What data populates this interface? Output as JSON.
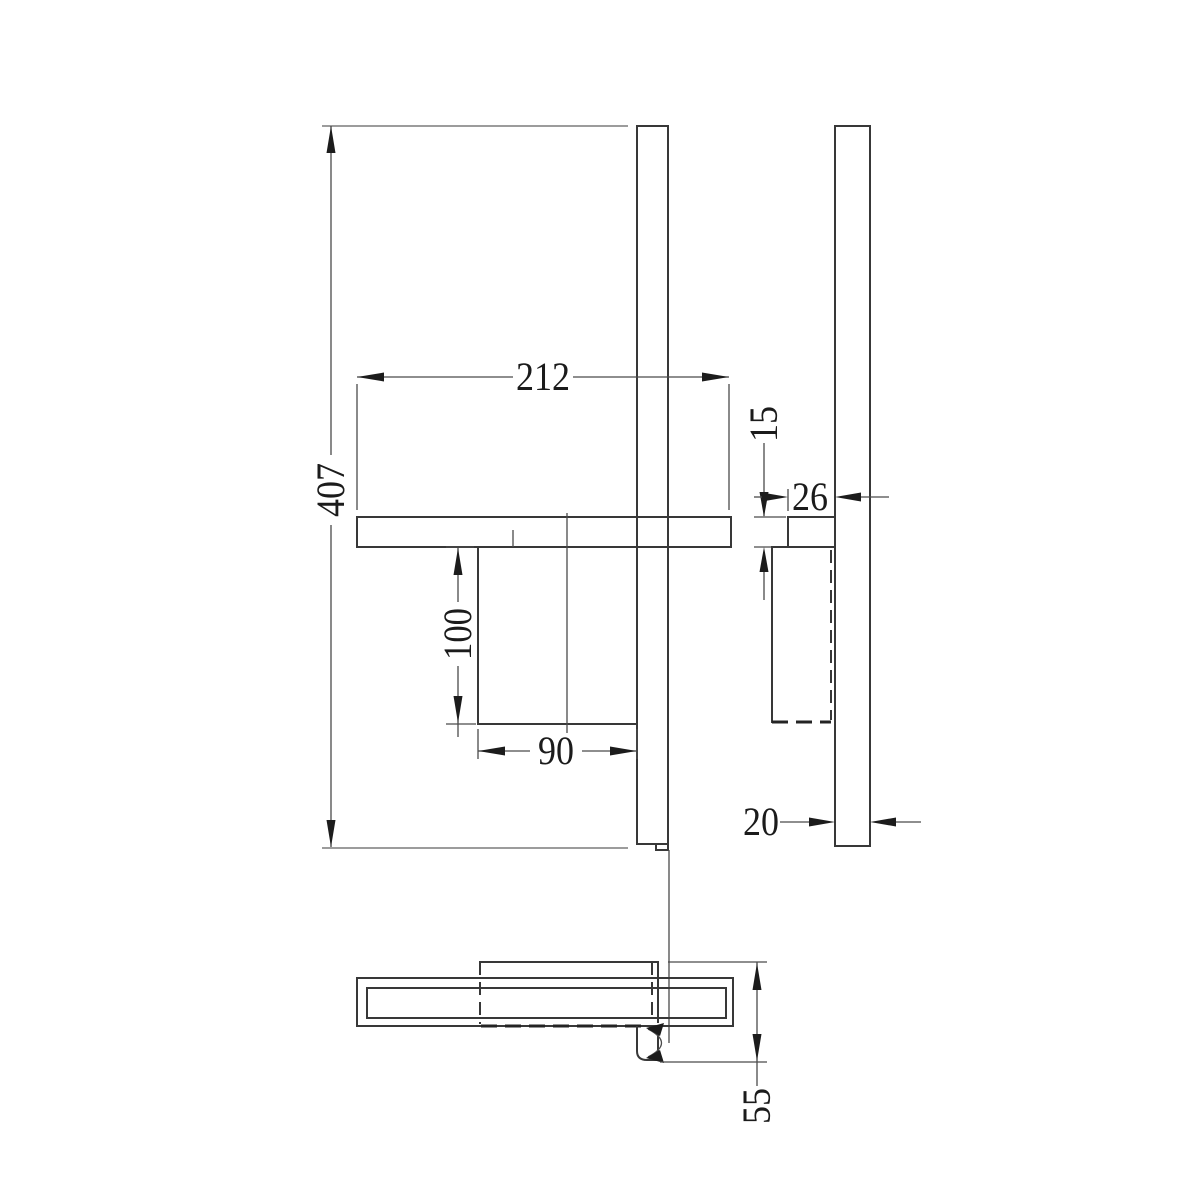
{
  "drawing": {
    "type": "technical-orthographic-drawing",
    "colors": {
      "background": "#ffffff",
      "object_line": "#383838",
      "dimension_line": "#4a4a4a",
      "arrow": "#1c1c1c"
    },
    "dimensions": {
      "overall_height": "407",
      "shelf_width": "212",
      "holder_height": "100",
      "holder_width": "90",
      "shelf_thickness": "15",
      "shelf_depth": "26",
      "rail_depth": "20",
      "overall_depth": "55"
    }
  }
}
